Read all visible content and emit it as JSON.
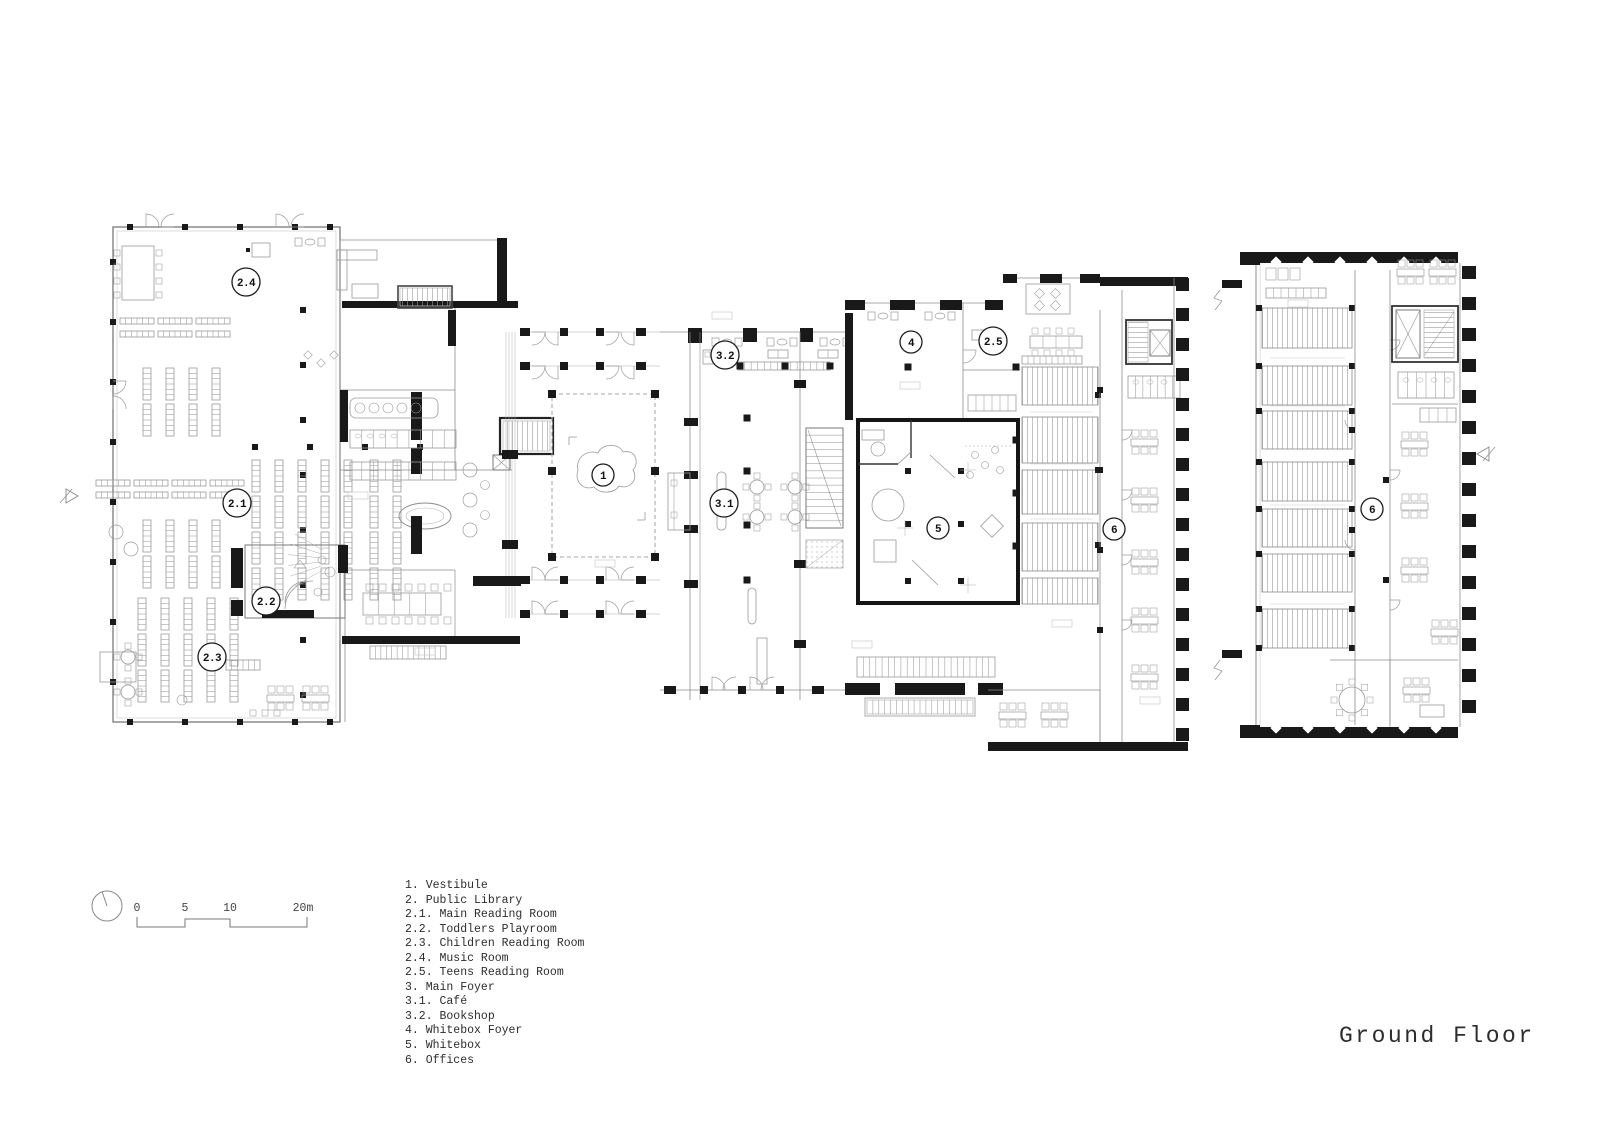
{
  "document": {
    "title": "Ground Floor"
  },
  "scale_bar": {
    "labels": [
      "0",
      "5",
      "10",
      "20m"
    ]
  },
  "north_arrow": {
    "icon": "compass-circle-icon"
  },
  "legend": {
    "items": [
      "1. Vestibule",
      "2. Public Library",
      "2.1. Main Reading Room",
      "2.2. Toddlers Playroom",
      "2.3. Children Reading Room",
      "2.4. Music Room",
      "2.5. Teens Reading Room",
      "3. Main Foyer",
      "3.1. Café",
      "3.2. Bookshop",
      "4. Whitebox Foyer",
      "5. Whitebox",
      "6. Offices"
    ]
  },
  "plan": {
    "room_markers": [
      {
        "label": "1",
        "x": 603,
        "y": 475,
        "r": 11
      },
      {
        "label": "2.1",
        "x": 237,
        "y": 503,
        "r": 14
      },
      {
        "label": "2.2",
        "x": 266,
        "y": 601,
        "r": 14
      },
      {
        "label": "2.3",
        "x": 212,
        "y": 657,
        "r": 14
      },
      {
        "label": "2.4",
        "x": 246,
        "y": 282,
        "r": 14
      },
      {
        "label": "2.5",
        "x": 993,
        "y": 341,
        "r": 14
      },
      {
        "label": "3.1",
        "x": 724,
        "y": 503,
        "r": 14
      },
      {
        "label": "3.2",
        "x": 725,
        "y": 355,
        "r": 14
      },
      {
        "label": "4",
        "x": 911,
        "y": 342,
        "r": 11
      },
      {
        "label": "5",
        "x": 938,
        "y": 528,
        "r": 11
      },
      {
        "label": "6",
        "x": 1114,
        "y": 529,
        "r": 11
      },
      {
        "label": "6",
        "x": 1372,
        "y": 509,
        "r": 11
      }
    ]
  }
}
